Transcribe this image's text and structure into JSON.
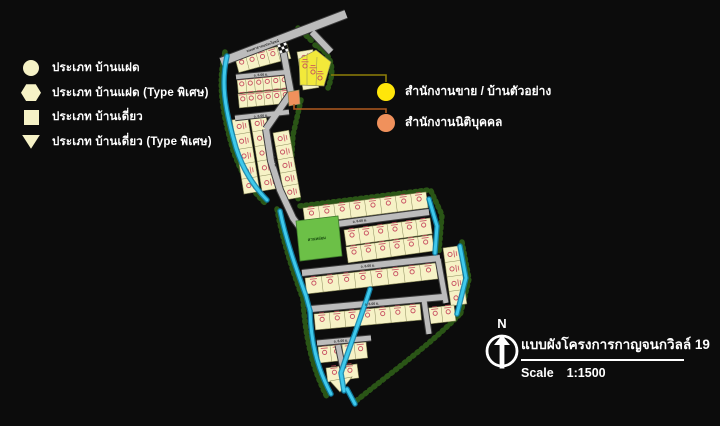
{
  "colors": {
    "bg": "#0c0c0c",
    "cream": "#F6F2C6",
    "plot_line": "#8A8A5A",
    "marker": "#C64A5E",
    "road_fill": "#BCBCBC",
    "road_edge": "#3C3C3C",
    "road_label": "#2E2E2E",
    "canal": "#3EC9EC",
    "canal_edge": "#0F82A8",
    "vegetation": "#2C5A17",
    "park": "#6CC047",
    "park_text": "#174A0F",
    "sales_yellow": "#F2E93A",
    "callout_yellow": "#FFE60A",
    "juristic_orange": "#F0915C",
    "connector_yellow": "#8F7E08",
    "connector_orange": "#B05A1F"
  },
  "legend": {
    "items": [
      {
        "shape": "circle",
        "label": "ประเภท บ้านแฝด"
      },
      {
        "shape": "hexagon",
        "label": "ประเภท บ้านแฝด (Type พิเศษ)"
      },
      {
        "shape": "square",
        "label": "ประเภท บ้านเดี่ยว"
      },
      {
        "shape": "triangle-down",
        "label": "ประเภท บ้านเดี่ยว (Type พิเศษ)"
      }
    ]
  },
  "callouts": [
    {
      "color": "#FFE60A",
      "label": "สำนักงานขาย / บ้านตัวอย่าง"
    },
    {
      "color": "#F0915C",
      "label": "สำนักงานนิติบุคคล"
    }
  ],
  "compass": {
    "label": "N"
  },
  "title_block": {
    "title": "แบบผังโครงการกาญจนกวิลล์ 19",
    "scale_label": "Scale",
    "scale_value": "1:1500"
  },
  "map": {
    "plot_rows": [
      [
        235,
        58,
        287,
        44,
        5,
        15
      ],
      [
        237,
        79,
        288,
        74,
        6,
        14
      ],
      [
        238,
        94,
        289,
        89,
        6,
        14
      ],
      [
        232,
        120,
        244,
        194,
        5,
        -16
      ],
      [
        250,
        117,
        262,
        191,
        5,
        -16
      ],
      [
        297,
        52,
        303,
        90,
        3,
        -16
      ],
      [
        273,
        133,
        285,
        200,
        5,
        -16
      ],
      [
        303,
        208,
        426,
        192,
        8,
        16
      ],
      [
        344,
        230,
        430,
        218,
        6,
        16
      ],
      [
        346,
        247,
        432,
        235,
        6,
        16
      ],
      [
        305,
        278,
        436,
        263,
        8,
        16
      ],
      [
        443,
        248,
        451,
        306,
        4,
        -16
      ],
      [
        314,
        314,
        420,
        304,
        7,
        16
      ],
      [
        428,
        308,
        454,
        305,
        2,
        16
      ],
      [
        318,
        347,
        366,
        342,
        4,
        16
      ],
      [
        326,
        368,
        357,
        364,
        2,
        14
      ]
    ],
    "extra_blocks": [
      "330,381 352,377 340,392"
    ],
    "roads": [
      {
        "p": "M221,62 L346,14",
        "w": 8
      },
      {
        "p": "M312,32 L331,52",
        "w": 6
      },
      {
        "p": "M236,77 L288,72",
        "w": 4.5
      },
      {
        "p": "M235,118 L289,112",
        "w": 4.5
      },
      {
        "p": "M283,50 L291,93",
        "w": 6
      },
      {
        "p": "M291,93 L266,129",
        "w": 6
      },
      {
        "p": "M266,129 L271,161 L280,190 L293,218 L301,229",
        "w": 6
      },
      {
        "p": "M299,229 L429,212",
        "w": 6
      },
      {
        "p": "M302,273 L440,258",
        "w": 6
      },
      {
        "p": "M438,259 L446,303",
        "w": 5
      },
      {
        "p": "M311,309 L443,297",
        "w": 6
      },
      {
        "p": "M424,300 L429,334",
        "w": 5
      },
      {
        "p": "M317,343 L371,338",
        "w": 5
      },
      {
        "p": "M338,345 L343,369",
        "w": 5
      }
    ],
    "road_labels": [
      {
        "x": 263,
        "y": 47,
        "r": -18,
        "t": "ถนนสาธารณประโยชน์"
      },
      {
        "x": 261,
        "y": 76,
        "r": -5,
        "t": "ถ. 6.00 ม."
      },
      {
        "x": 261,
        "y": 117,
        "r": -6,
        "t": "ถ. 6.00 ม."
      },
      {
        "x": 274,
        "y": 160,
        "r": 82,
        "t": "ถ. 6.00 ม."
      },
      {
        "x": 360,
        "y": 222,
        "r": -7,
        "t": "ถ. 6.00 ม."
      },
      {
        "x": 368,
        "y": 267,
        "r": -6,
        "t": "ถ. 6.00 ม."
      },
      {
        "x": 372,
        "y": 305,
        "r": -5,
        "t": "ถ. 6.00 ม."
      },
      {
        "x": 341,
        "y": 342,
        "r": -5,
        "t": "ถ. 6.00 ม."
      }
    ],
    "canals": [
      "M227,56 C221,82 224,106 236,148 C243,170 255,188 267,200",
      "M280,211 C286,240 296,268 306,296 L310,311",
      "M310,311 C311,340 316,366 331,394",
      "M429,199 L437,226 L435,253",
      "M460,246 L466,278 L457,314",
      "M370,289 C362,315 350,345 341,373 L344,391",
      "M347,389 L355,404"
    ],
    "vegetation": [
      "M225,52 C218,82 221,108 233,150 C241,174 253,192 266,204",
      "M277,209 C283,242 293,272 303,299 C305,334 311,366 327,397",
      "M315,45 C331,53 336,68 328,88",
      "M301,100 L293,135 L291,170 L299,202",
      "M300,206 L428,190",
      "M431,191 L442,215 L439,251",
      "M462,242 L469,279 L460,316",
      "M459,315 C432,343 392,372 356,401",
      "M298,28 L314,43"
    ],
    "park": {
      "points": "296,221 338,216 342,256 300,261",
      "label": "สวนหย่อม",
      "lx": 317,
      "ly": 240,
      "lr": -7
    },
    "sales_office": {
      "points": "299,59 316,50 331,62 324,86 300,85",
      "divs": [
        "M307,54.5 L307,85",
        "M317,57 L316,85.5"
      ],
      "markers": [
        [
          305,
          66
        ],
        [
          313,
          72
        ],
        [
          320,
          78
        ]
      ]
    },
    "juristic_office": {
      "points": "288,92 299,90 300,104 289,106"
    },
    "guard": {
      "x": 283,
      "y": 48,
      "s": 3.1,
      "r": -16
    },
    "connectors": [
      {
        "p": "M331,75 L386,75 L386,82",
        "color": "#8F7E08"
      },
      {
        "p": "M294,104 L294,109 L386,109 L386,113",
        "color": "#B05A1F"
      }
    ]
  }
}
